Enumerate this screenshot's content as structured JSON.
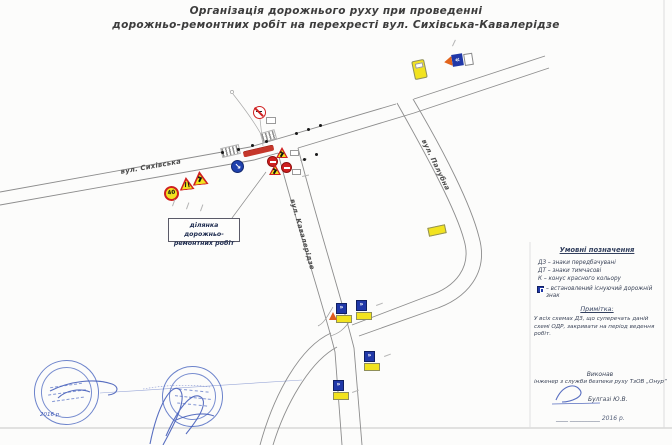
{
  "title": {
    "line1": "Організація дорожнього руху при проведенні",
    "line2": "дорожньо-ремонтних робіт на перехресті вул. Сихівська-Кавалерідзе"
  },
  "map": {
    "streets": [
      "вул. Сихівська",
      "вул. Кавалерідзе",
      "вул. Палубна"
    ],
    "speed_limit": "40",
    "work_zone": {
      "line1": "ділянка дорожньо-",
      "line2": "ремонтних робіт"
    }
  },
  "legend": {
    "heading": "Умовні позначення",
    "items": [
      "ДЗ – знаки передбачувані",
      "ДТ – знаки тимчасові",
      "К – конус красного кольору",
      "– встановлений існуючий дорожній знак"
    ],
    "note_heading": "Примітка:",
    "note_text": "У всіх схемах ДЗ, що суперечать даній схемі ОДР, закривати на період ведення робіт."
  },
  "signoff": {
    "executed_by": "Виконав",
    "role": "інженер з служби безпеки руху ТзОВ „Онур“",
    "name": "Булгазі Ю.В.",
    "date_line": "____  __________ 2016 р.",
    "stamp_date": "2016 р."
  },
  "colors": {
    "accent_red": "#cf2020",
    "temp_yellow": "#f2e31f",
    "sign_blue": "#2038a8",
    "stamp_blue": "#4260be"
  }
}
